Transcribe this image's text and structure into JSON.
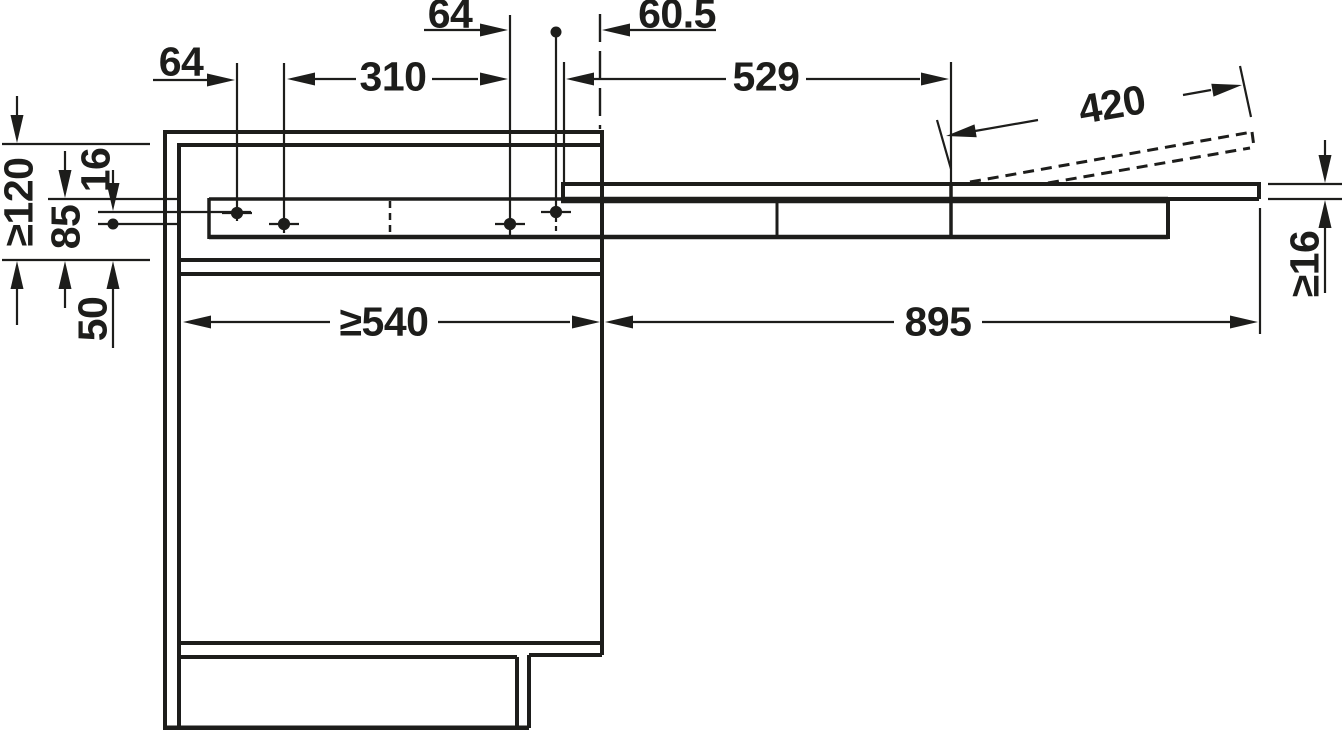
{
  "drawing": {
    "type": "technical-installation-drawing",
    "background_color": "#ffffff",
    "line_color": "#1d1d1b",
    "dimensions_horizontal": {
      "hole_pitch_rear": "64",
      "hole_pitch_middle": "310",
      "hole_pitch_front": "64",
      "front_edge_offset": "60.5",
      "slide_section_length": "529",
      "flap_length": "420",
      "cabinet_inner_depth_min": "≥540",
      "extension_length": "895"
    },
    "dimensions_vertical": {
      "clearance_height_min": "≥120",
      "hole_row_offset": "16",
      "fitting_height": "85",
      "shelf_offset": "50",
      "top_panel_thickness_min": "≥16"
    }
  }
}
